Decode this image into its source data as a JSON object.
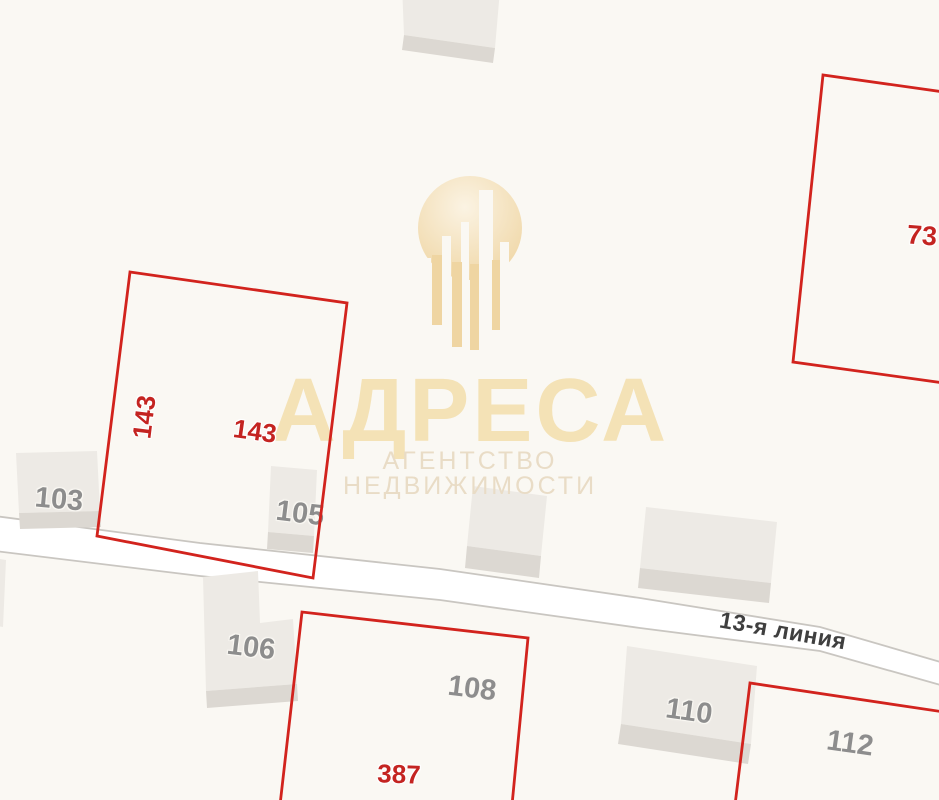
{
  "watermark": {
    "brand": "АДРЕСА",
    "tagline": "АГЕНТСТВО НЕДВИЖИМОСТИ"
  },
  "road": {
    "name": "13-я линия"
  },
  "parcel_labels": {
    "p143_side": "143",
    "p143_main": "143",
    "p387": "387",
    "p73": "73"
  },
  "building_labels": {
    "b103": "103",
    "b105": "105",
    "b106": "106",
    "b108": "108",
    "b110": "110",
    "b112": "112"
  },
  "colors": {
    "background": "#faf8f3",
    "road_fill": "#ffffff",
    "road_border": "#c9c6c1",
    "building_fill": "#edeae5",
    "building_base": "#dcd8d2",
    "parcel_line": "#d2231d",
    "parcel_label": "#c42421",
    "building_label": "#8d8d8d",
    "road_label": "#3f3f3f",
    "watermark_gold": "#efd5a2",
    "watermark_gold_light": "#fbf3e3",
    "watermark_title": "#f4e2b6",
    "watermark_tagline": "#e9dcc6"
  }
}
